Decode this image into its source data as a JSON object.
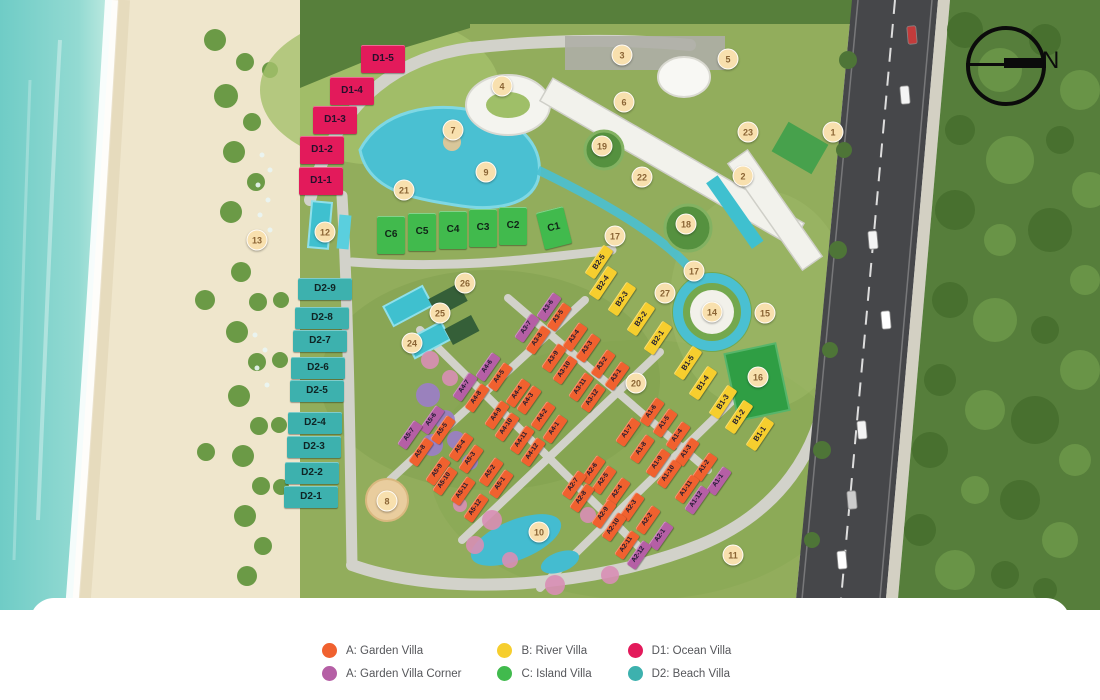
{
  "map": {
    "compass": {
      "label": "N"
    },
    "villa_styles": {
      "garden": {
        "bg": "#F0612F",
        "fg": "#1D1930",
        "w": 29,
        "h": 11,
        "rot": -55,
        "fs": 6.5
      },
      "corner": {
        "bg": "#B55FA5",
        "fg": "#1D1930",
        "w": 29,
        "h": 11,
        "rot": -55,
        "fs": 6.5
      },
      "river": {
        "bg": "#F6CE2E",
        "fg": "#1D1930",
        "w": 34,
        "h": 12,
        "rot": -56,
        "fs": 7.5
      },
      "island": {
        "bg": "#41BA4D",
        "fg": "#102417",
        "w": 28,
        "h": 38,
        "rot": 0,
        "fs": 10
      },
      "ocean": {
        "bg": "#E31A5B",
        "fg": "#26102C",
        "w": 44,
        "h": 28,
        "rot": 0,
        "fs": 10
      },
      "beach": {
        "bg": "#3DB1AE",
        "fg": "#0F2424",
        "w": 54,
        "h": 22,
        "rot": 0,
        "fs": 10
      }
    },
    "villas": [
      {
        "label": "D1-5",
        "x": 383,
        "y": 59,
        "t": "ocean"
      },
      {
        "label": "D1-4",
        "x": 352,
        "y": 91,
        "t": "ocean"
      },
      {
        "label": "D1-3",
        "x": 335,
        "y": 120,
        "t": "ocean"
      },
      {
        "label": "D1-2",
        "x": 322,
        "y": 150,
        "t": "ocean"
      },
      {
        "label": "D1-1",
        "x": 321,
        "y": 181,
        "t": "ocean"
      },
      {
        "label": "D2-9",
        "x": 325,
        "y": 289,
        "t": "beach"
      },
      {
        "label": "D2-8",
        "x": 322,
        "y": 318,
        "t": "beach"
      },
      {
        "label": "D2-7",
        "x": 320,
        "y": 341,
        "t": "beach"
      },
      {
        "label": "D2-6",
        "x": 318,
        "y": 368,
        "t": "beach"
      },
      {
        "label": "D2-5",
        "x": 317,
        "y": 391,
        "t": "beach"
      },
      {
        "label": "D2-4",
        "x": 315,
        "y": 423,
        "t": "beach"
      },
      {
        "label": "D2-3",
        "x": 314,
        "y": 447,
        "t": "beach"
      },
      {
        "label": "D2-2",
        "x": 312,
        "y": 473,
        "t": "beach"
      },
      {
        "label": "D2-1",
        "x": 311,
        "y": 497,
        "t": "beach"
      },
      {
        "label": "C6",
        "x": 391,
        "y": 235,
        "t": "island"
      },
      {
        "label": "C5",
        "x": 422,
        "y": 232,
        "t": "island"
      },
      {
        "label": "C4",
        "x": 453,
        "y": 230,
        "t": "island"
      },
      {
        "label": "C3",
        "x": 483,
        "y": 228,
        "t": "island"
      },
      {
        "label": "C2",
        "x": 513,
        "y": 226,
        "t": "island"
      },
      {
        "label": "C1",
        "x": 554,
        "y": 228,
        "t": "island",
        "rot": -14
      },
      {
        "label": "B2-5",
        "x": 599,
        "y": 262,
        "t": "river"
      },
      {
        "label": "B2-4",
        "x": 603,
        "y": 283,
        "t": "river"
      },
      {
        "label": "B2-3",
        "x": 622,
        "y": 299,
        "t": "river"
      },
      {
        "label": "B2-2",
        "x": 641,
        "y": 319,
        "t": "river"
      },
      {
        "label": "B2-1",
        "x": 658,
        "y": 338,
        "t": "river"
      },
      {
        "label": "B1-5",
        "x": 688,
        "y": 363,
        "t": "river"
      },
      {
        "label": "B1-4",
        "x": 703,
        "y": 383,
        "t": "river"
      },
      {
        "label": "B1-3",
        "x": 723,
        "y": 402,
        "t": "river"
      },
      {
        "label": "B1-2",
        "x": 739,
        "y": 417,
        "t": "river"
      },
      {
        "label": "B1-1",
        "x": 760,
        "y": 434,
        "t": "river"
      },
      {
        "label": "A3-6",
        "x": 549,
        "y": 307,
        "t": "corner"
      },
      {
        "label": "A3-5",
        "x": 559,
        "y": 317,
        "t": "garden"
      },
      {
        "label": "A3-7",
        "x": 527,
        "y": 328,
        "t": "corner"
      },
      {
        "label": "A3-8",
        "x": 538,
        "y": 340,
        "t": "garden"
      },
      {
        "label": "A3-4",
        "x": 575,
        "y": 337,
        "t": "garden"
      },
      {
        "label": "A3-3",
        "x": 588,
        "y": 348,
        "t": "garden"
      },
      {
        "label": "A3-9",
        "x": 554,
        "y": 358,
        "t": "garden"
      },
      {
        "label": "A3-2",
        "x": 603,
        "y": 364,
        "t": "garden"
      },
      {
        "label": "A3-10",
        "x": 565,
        "y": 370,
        "t": "garden"
      },
      {
        "label": "A3-1",
        "x": 617,
        "y": 376,
        "t": "garden"
      },
      {
        "label": "A3-11",
        "x": 581,
        "y": 387,
        "t": "garden"
      },
      {
        "label": "A3-12",
        "x": 593,
        "y": 398,
        "t": "garden"
      },
      {
        "label": "A4-6",
        "x": 488,
        "y": 367,
        "t": "corner"
      },
      {
        "label": "A4-5",
        "x": 500,
        "y": 377,
        "t": "garden"
      },
      {
        "label": "A4-7",
        "x": 465,
        "y": 387,
        "t": "corner"
      },
      {
        "label": "A4-4",
        "x": 518,
        "y": 393,
        "t": "garden"
      },
      {
        "label": "A4-8",
        "x": 477,
        "y": 398,
        "t": "garden"
      },
      {
        "label": "A4-3",
        "x": 529,
        "y": 400,
        "t": "garden"
      },
      {
        "label": "A4-9",
        "x": 497,
        "y": 415,
        "t": "garden"
      },
      {
        "label": "A4-2",
        "x": 543,
        "y": 416,
        "t": "garden"
      },
      {
        "label": "A4-10",
        "x": 507,
        "y": 427,
        "t": "garden"
      },
      {
        "label": "A4-1",
        "x": 555,
        "y": 429,
        "t": "garden"
      },
      {
        "label": "A4-11",
        "x": 522,
        "y": 440,
        "t": "garden"
      },
      {
        "label": "A4-12",
        "x": 533,
        "y": 452,
        "t": "garden"
      },
      {
        "label": "A5-6",
        "x": 432,
        "y": 420,
        "t": "corner"
      },
      {
        "label": "A5-5",
        "x": 443,
        "y": 430,
        "t": "garden"
      },
      {
        "label": "A5-7",
        "x": 410,
        "y": 435,
        "t": "corner"
      },
      {
        "label": "A5-4",
        "x": 461,
        "y": 447,
        "t": "garden"
      },
      {
        "label": "A5-8",
        "x": 421,
        "y": 452,
        "t": "garden"
      },
      {
        "label": "A5-3",
        "x": 471,
        "y": 459,
        "t": "garden"
      },
      {
        "label": "A5-9",
        "x": 438,
        "y": 471,
        "t": "garden"
      },
      {
        "label": "A5-2",
        "x": 491,
        "y": 472,
        "t": "garden"
      },
      {
        "label": "A5-10",
        "x": 445,
        "y": 481,
        "t": "garden"
      },
      {
        "label": "A5-1",
        "x": 501,
        "y": 484,
        "t": "garden"
      },
      {
        "label": "A5-11",
        "x": 463,
        "y": 491,
        "t": "garden"
      },
      {
        "label": "A5-12",
        "x": 476,
        "y": 508,
        "t": "garden"
      },
      {
        "label": "A1-6",
        "x": 652,
        "y": 412,
        "t": "garden"
      },
      {
        "label": "A1-5",
        "x": 665,
        "y": 423,
        "t": "garden"
      },
      {
        "label": "A1-7",
        "x": 628,
        "y": 432,
        "t": "garden"
      },
      {
        "label": "A1-4",
        "x": 678,
        "y": 436,
        "t": "garden"
      },
      {
        "label": "A1-8",
        "x": 642,
        "y": 449,
        "t": "garden"
      },
      {
        "label": "A1-3",
        "x": 687,
        "y": 452,
        "t": "garden"
      },
      {
        "label": "A1-9",
        "x": 658,
        "y": 463,
        "t": "garden"
      },
      {
        "label": "A1-2",
        "x": 705,
        "y": 467,
        "t": "garden"
      },
      {
        "label": "A1-10",
        "x": 669,
        "y": 474,
        "t": "garden"
      },
      {
        "label": "A1-1",
        "x": 719,
        "y": 481,
        "t": "corner"
      },
      {
        "label": "A1-11",
        "x": 687,
        "y": 489,
        "t": "garden"
      },
      {
        "label": "A1-12",
        "x": 697,
        "y": 500,
        "t": "corner"
      },
      {
        "label": "A2-6",
        "x": 593,
        "y": 470,
        "t": "garden"
      },
      {
        "label": "A2-5",
        "x": 604,
        "y": 480,
        "t": "garden"
      },
      {
        "label": "A2-7",
        "x": 574,
        "y": 485,
        "t": "garden"
      },
      {
        "label": "A2-4",
        "x": 618,
        "y": 492,
        "t": "garden"
      },
      {
        "label": "A2-8",
        "x": 582,
        "y": 498,
        "t": "garden"
      },
      {
        "label": "A2-3",
        "x": 632,
        "y": 507,
        "t": "garden"
      },
      {
        "label": "A2-9",
        "x": 604,
        "y": 514,
        "t": "garden"
      },
      {
        "label": "A2-2",
        "x": 648,
        "y": 520,
        "t": "garden"
      },
      {
        "label": "A2-10",
        "x": 614,
        "y": 527,
        "t": "garden"
      },
      {
        "label": "A2-1",
        "x": 661,
        "y": 536,
        "t": "corner"
      },
      {
        "label": "A2-11",
        "x": 627,
        "y": 545,
        "t": "garden"
      },
      {
        "label": "A2-12",
        "x": 639,
        "y": 555,
        "t": "corner"
      }
    ],
    "markers": [
      {
        "n": "1",
        "x": 833,
        "y": 132
      },
      {
        "n": "2",
        "x": 743,
        "y": 176
      },
      {
        "n": "3",
        "x": 622,
        "y": 55
      },
      {
        "n": "4",
        "x": 502,
        "y": 86
      },
      {
        "n": "5",
        "x": 728,
        "y": 59
      },
      {
        "n": "6",
        "x": 624,
        "y": 102
      },
      {
        "n": "7",
        "x": 453,
        "y": 130
      },
      {
        "n": "8",
        "x": 387,
        "y": 501
      },
      {
        "n": "9",
        "x": 486,
        "y": 172
      },
      {
        "n": "10",
        "x": 539,
        "y": 532
      },
      {
        "n": "11",
        "x": 733,
        "y": 555
      },
      {
        "n": "12",
        "x": 325,
        "y": 232
      },
      {
        "n": "13",
        "x": 257,
        "y": 240
      },
      {
        "n": "14",
        "x": 712,
        "y": 312
      },
      {
        "n": "15",
        "x": 765,
        "y": 313
      },
      {
        "n": "16",
        "x": 758,
        "y": 377
      },
      {
        "n": "17",
        "x": 615,
        "y": 236
      },
      {
        "n": "17",
        "x": 694,
        "y": 271
      },
      {
        "n": "18",
        "x": 686,
        "y": 224
      },
      {
        "n": "19",
        "x": 602,
        "y": 146
      },
      {
        "n": "20",
        "x": 636,
        "y": 383
      },
      {
        "n": "21",
        "x": 404,
        "y": 190
      },
      {
        "n": "22",
        "x": 642,
        "y": 177
      },
      {
        "n": "23",
        "x": 748,
        "y": 132
      },
      {
        "n": "24",
        "x": 412,
        "y": 343
      },
      {
        "n": "25",
        "x": 440,
        "y": 313
      },
      {
        "n": "26",
        "x": 465,
        "y": 283
      },
      {
        "n": "27",
        "x": 665,
        "y": 293
      }
    ]
  },
  "legend": {
    "items": [
      {
        "label": "A: Garden Villa",
        "color": "#F0612F"
      },
      {
        "label": "A: Garden Villa Corner",
        "color": "#B55FA5"
      },
      {
        "label": "B: River Villa",
        "color": "#F6CE2E"
      },
      {
        "label": "C: Island Villa",
        "color": "#41BA4D"
      },
      {
        "label": "D1: Ocean Villa",
        "color": "#E31A5B"
      },
      {
        "label": "D2: Beach Villa",
        "color": "#3DB1AE"
      }
    ]
  }
}
